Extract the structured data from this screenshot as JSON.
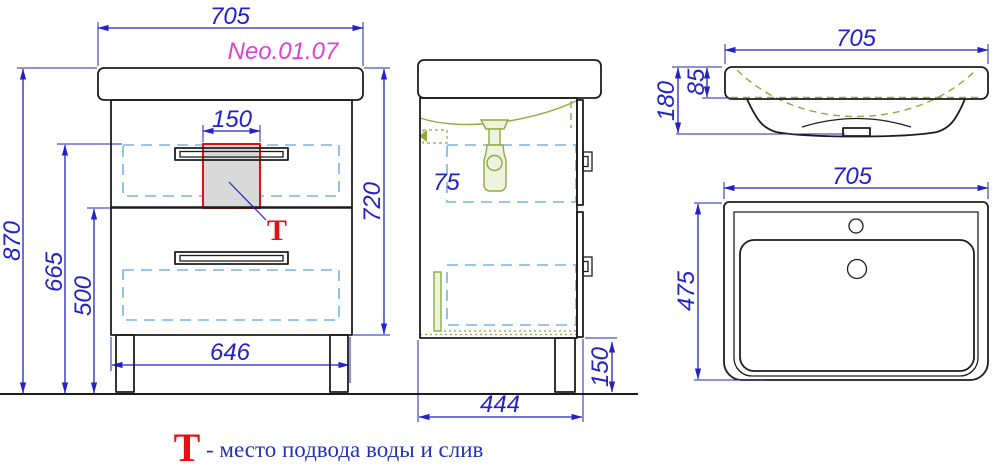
{
  "model_label": "Neo.01.07",
  "front_view": {
    "dim_width_top": "705",
    "dim_tech_width": "150",
    "dim_height_total": "870",
    "dim_height_665": "665",
    "dim_height_500": "500",
    "dim_height_720": "720",
    "dim_width_bottom": "646",
    "marker": "Т"
  },
  "side_view": {
    "dim_depth": "444",
    "dim_leg_height": "150",
    "dim_clearance": "75"
  },
  "sink_front_view": {
    "dim_width": "705",
    "dim_height": "180",
    "dim_rim": "85"
  },
  "sink_top_view": {
    "dim_width": "705",
    "dim_depth": "475"
  },
  "legend": {
    "symbol": "Т",
    "text": "- место подвода воды и слив"
  },
  "colors": {
    "dimension_blue": "#2222c6",
    "auxiliary_dashed_blue": "#76b4e6",
    "plumbing_green": "#8fab40",
    "highlight_red": "#e11212",
    "model_magenta": "#de41d1",
    "outline_black": "#1d1d1d",
    "tech_zone_fill": "#d9d9d9"
  }
}
